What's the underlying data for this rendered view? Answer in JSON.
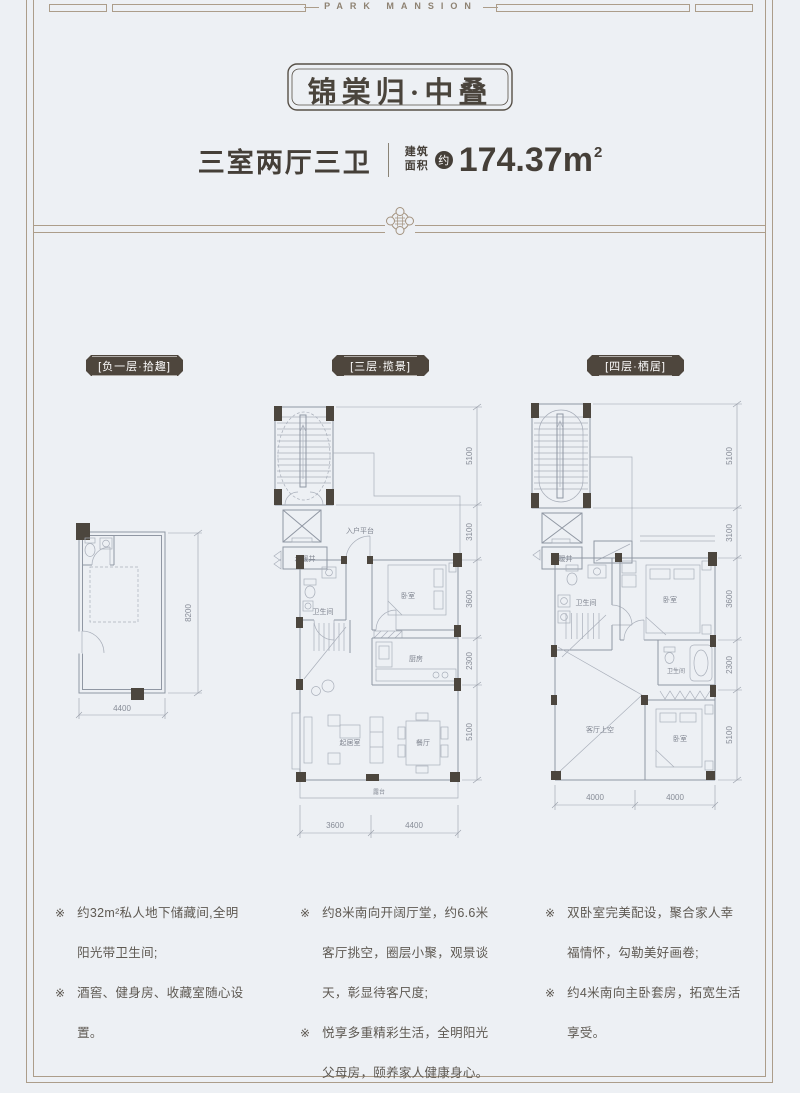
{
  "header": {
    "brand": "PARK MANSION",
    "title": "锦棠归·中叠",
    "spec": "三室两厅三卫",
    "area_label_1": "建筑",
    "area_label_2": "面积",
    "area_approx": "约",
    "area_value": "174.37m",
    "area_exp": "2"
  },
  "colors": {
    "background": "#edf0f4",
    "frame": "#ac9d8a",
    "ink": "#453f38",
    "badge_bg": "#4e463d",
    "plan_line": "#9097a3"
  },
  "plans": [
    {
      "badge": "[负一层·拾趣]",
      "dim_right": "8200",
      "dim_bottom": "4400"
    },
    {
      "badge": "[三层·揽景]",
      "labels": {
        "entry": "入户平台",
        "shaft": "水暖井",
        "bath": "卫生间",
        "bedroom": "卧室",
        "kitchen": "厨房",
        "living": "起居室",
        "dining": "餐厅",
        "terrace": "露台"
      },
      "dims_right": [
        "5100",
        "3100",
        "3600",
        "2300",
        "5100"
      ],
      "dims_bottom": [
        "3600",
        "4400"
      ]
    },
    {
      "badge": "[四层·栖居]",
      "labels": {
        "shaft": "水暖井",
        "bath1": "卫生间",
        "bedroom1": "卧室",
        "bath2": "卫生间",
        "void": "客厅上空",
        "bedroom2": "卧室"
      },
      "dims_right": [
        "5100",
        "3100",
        "3600",
        "2300",
        "5100"
      ],
      "dims_bottom": [
        "4000",
        "4000"
      ]
    }
  ],
  "notes": {
    "marker": "※",
    "col1": [
      "约32m²私人地下储藏间,全明阳光带卫生间;",
      "酒窖、健身房、收藏室随心设置。"
    ],
    "col2": [
      "约8米南向开阔厅堂，约6.6米客厅挑空，圈层小聚，观景谈天，彰显待客尺度;",
      "悦享多重精彩生活，全明阳光父母房，颐养家人健康身心。"
    ],
    "col3": [
      "双卧室完美配设，聚合家人幸福情怀，勾勒美好画卷;",
      "约4米南向主卧套房，拓宽生活享受。"
    ]
  }
}
